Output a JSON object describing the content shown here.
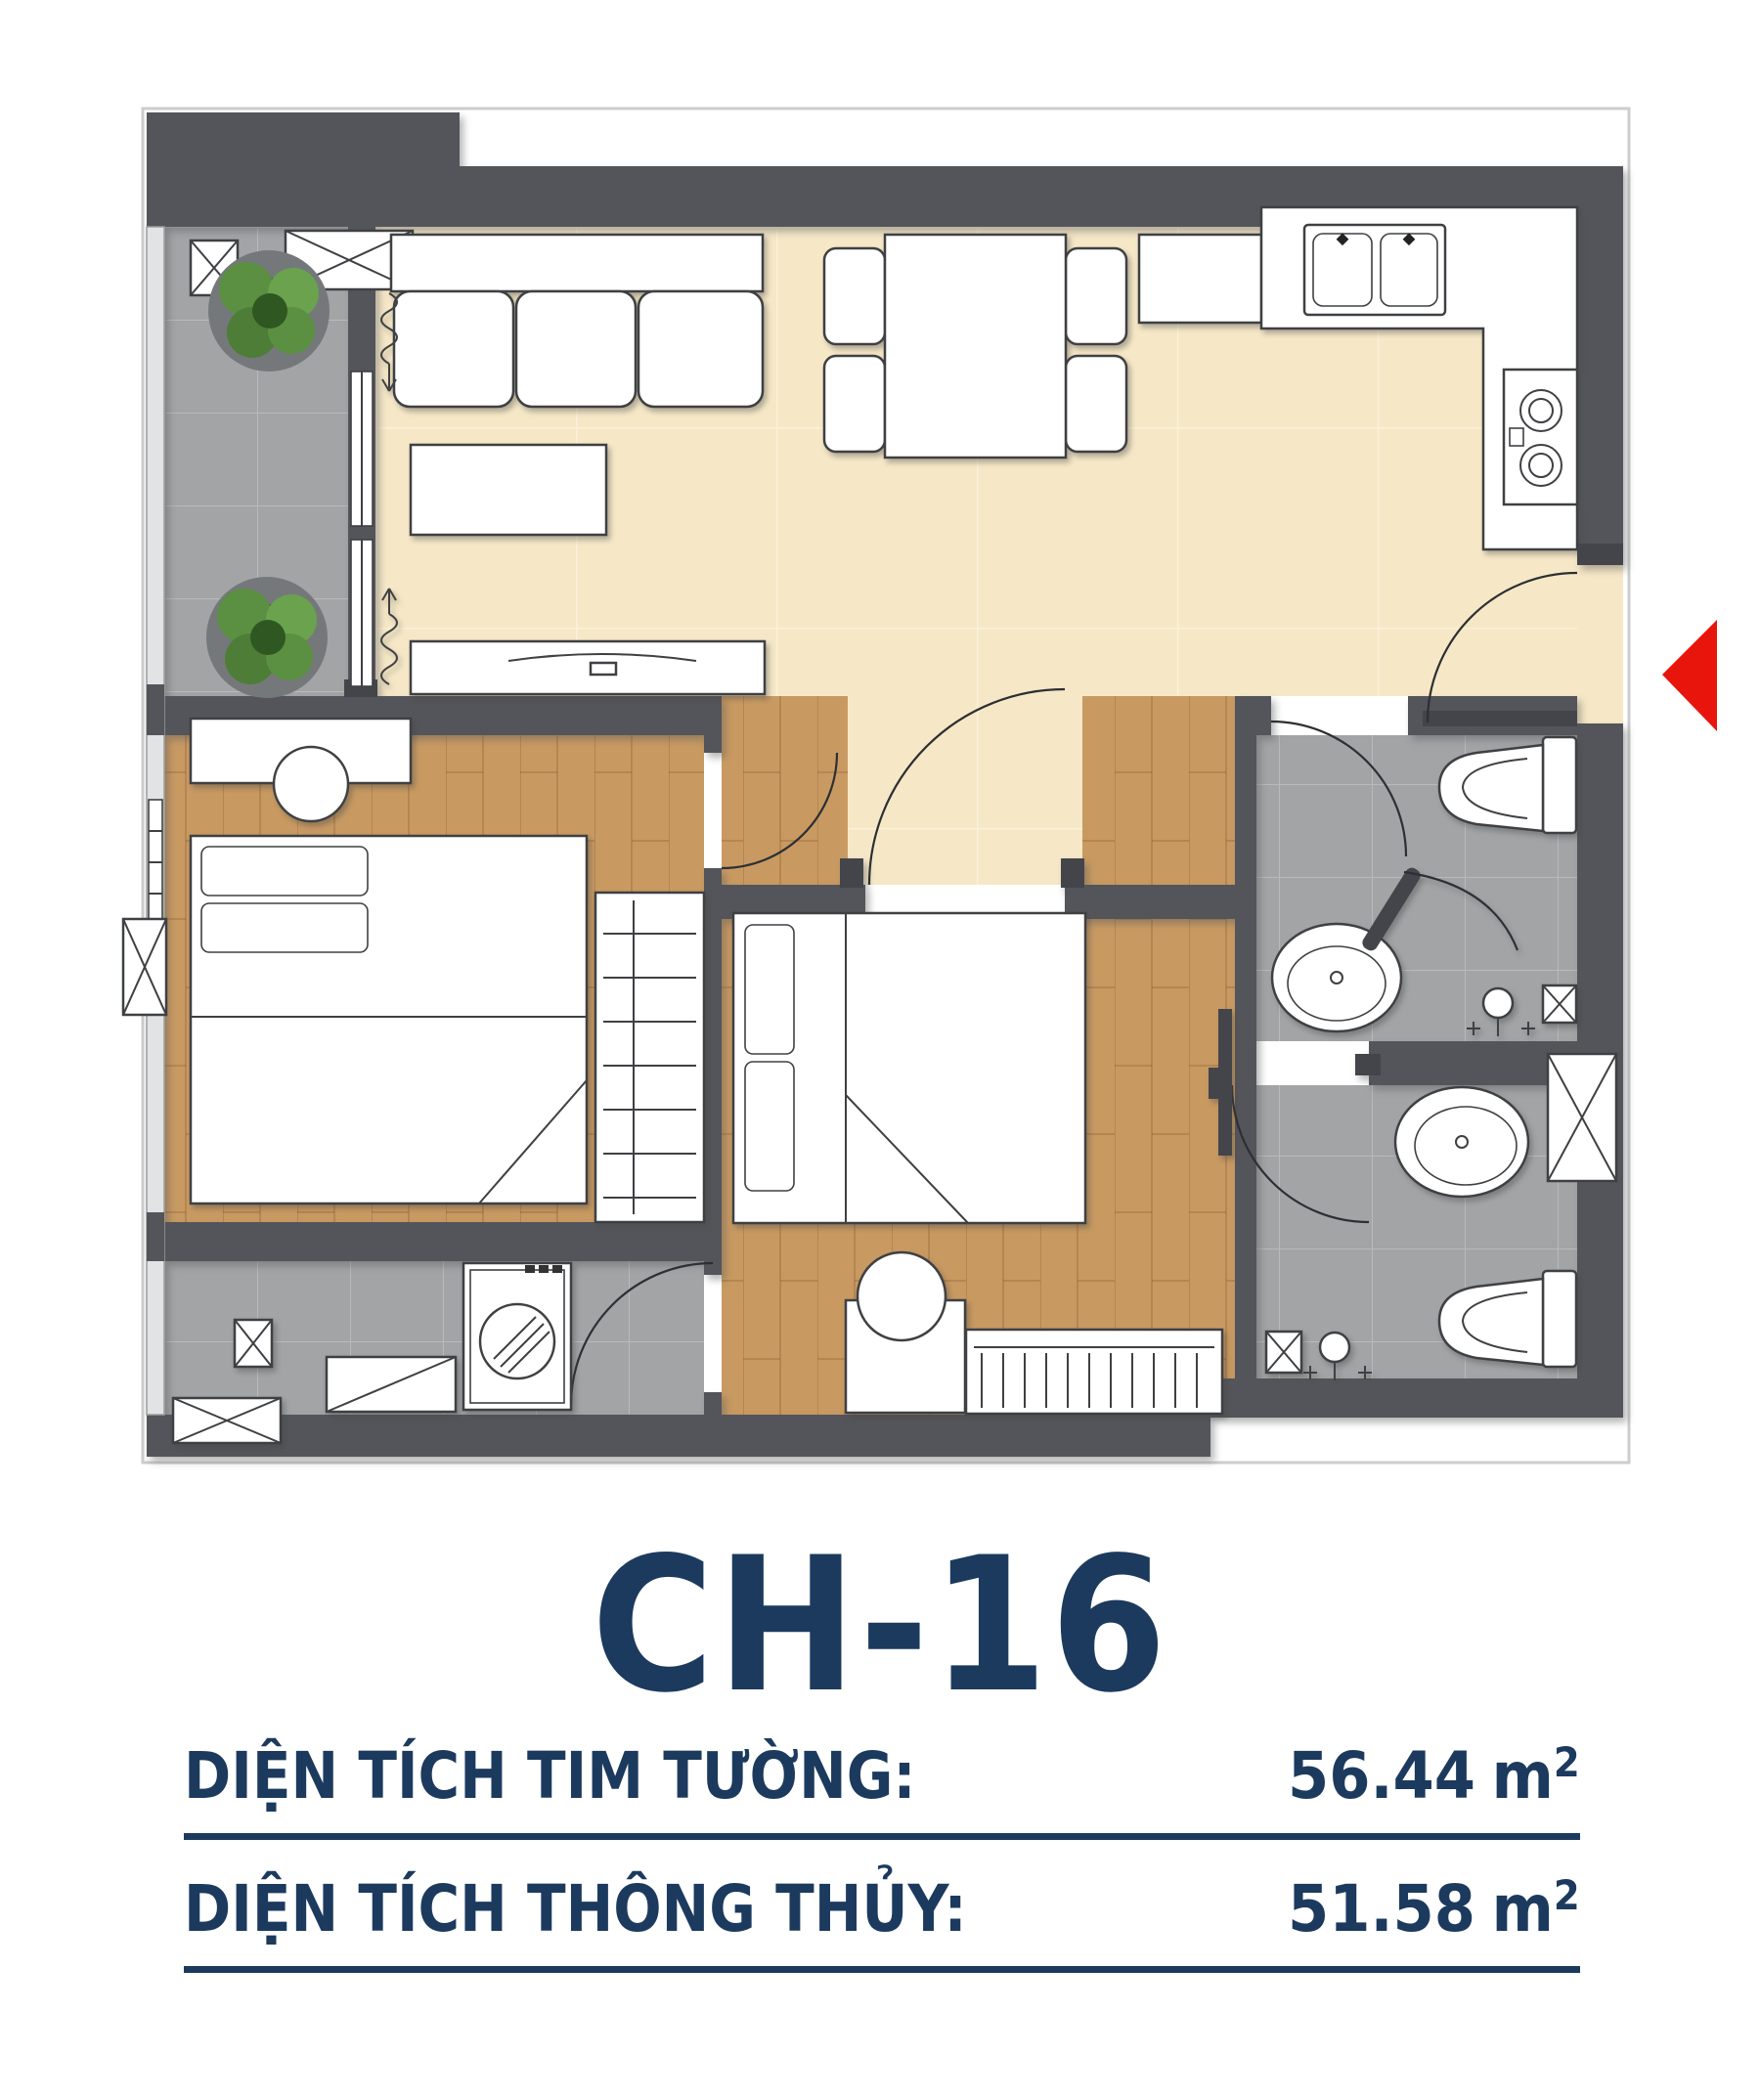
{
  "unit": {
    "code": "CH-16"
  },
  "areas": [
    {
      "label": "DIỆN TÍCH TIM TƯỜNG:",
      "value": "56.44",
      "unit": "m",
      "sup": "2"
    },
    {
      "label": "DIỆN TÍCH THÔNG THỦY:",
      "value": "51.58",
      "unit": "m",
      "sup": "2"
    }
  ],
  "colors": {
    "wall": "#54555a",
    "wall_dark": "#44454a",
    "floor_cream": "#f6e8c7",
    "floor_wood": "#c89a62",
    "floor_tile": "#a2a4a6",
    "grout": "#b7b9ba",
    "accent_red": "#e8150d",
    "text_navy": "#1c3a5e",
    "line": "#3f4043",
    "lightwall": "#e2e3e4",
    "plant_green": "#5b8f41",
    "plant_dark": "#3f6b2c"
  }
}
